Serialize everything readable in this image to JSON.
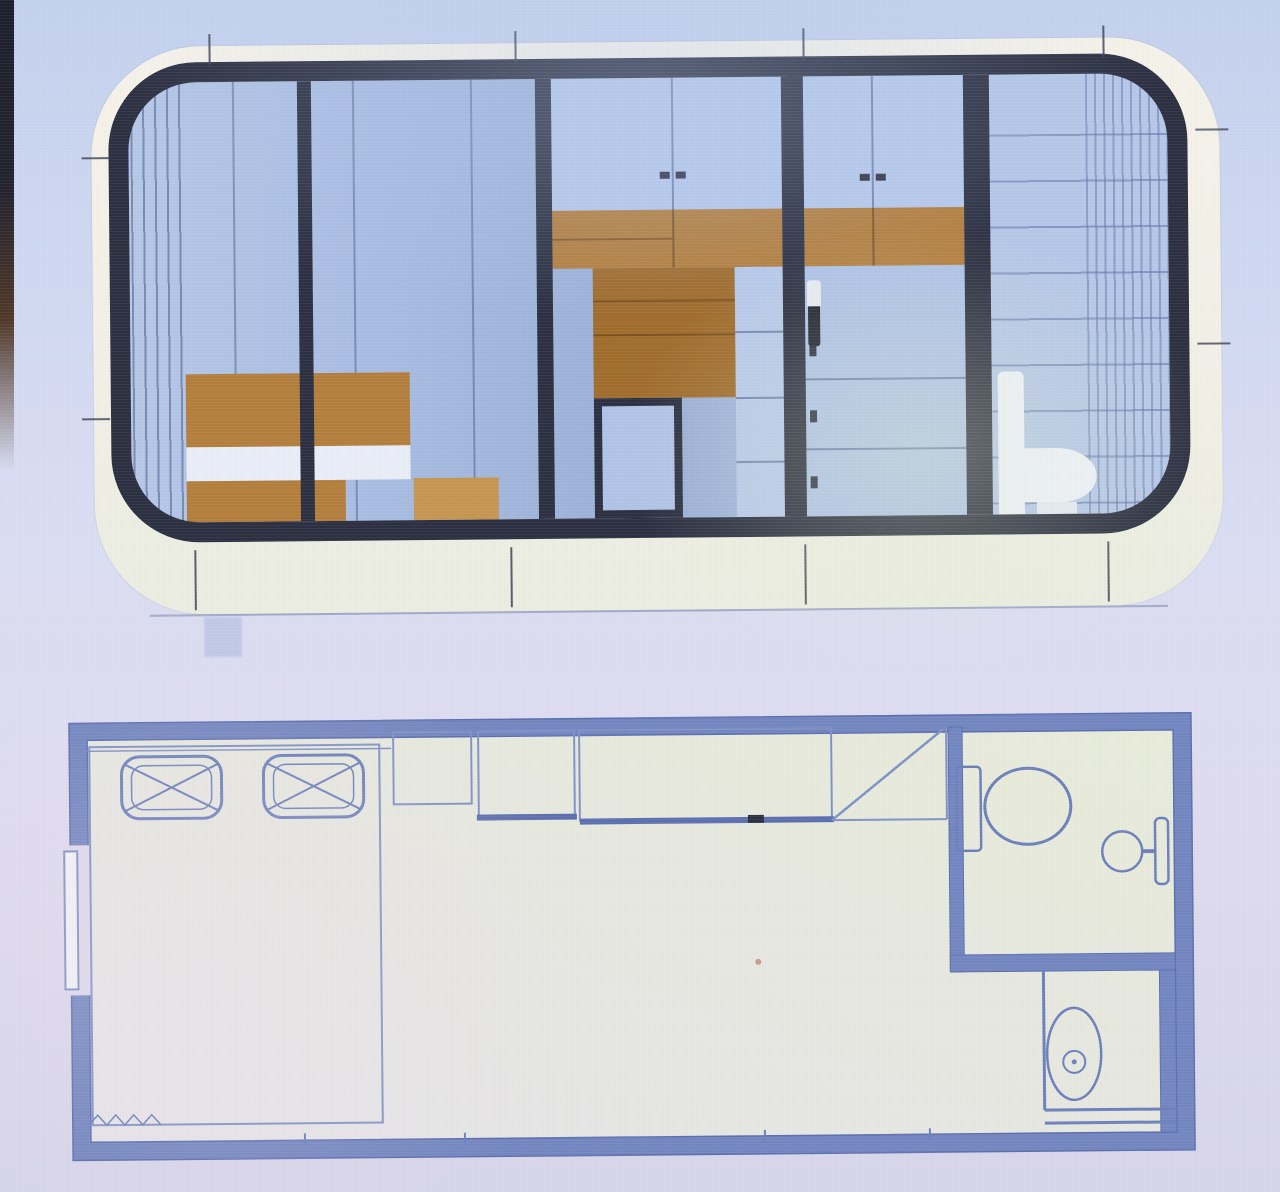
{
  "meta": {
    "kind": "photo-of-screen",
    "subject": "capsule tiny-house CAD drawing: side elevation above, floor plan below",
    "visible_text": "none"
  },
  "palette": {
    "bg_top": "#c3d1ed",
    "bg_mid": "#dbddf2",
    "bg_bottom": "#d7d5e9",
    "edge_dark": "#1b1f2b",
    "edge_brown": "#4f3827",
    "body": "#f5f2e9",
    "body_low": "#eaede0",
    "frame": "#2b2f40",
    "glass": "#a8bde2",
    "glass_light": "#b5c7e7",
    "tile_line": "#5f78ab",
    "wood": "#b37e3c",
    "wood_dark": "#a06c2c",
    "wood_light": "#c59551",
    "bedding": "#e9edf6",
    "cabinet": "#b7c9ea",
    "drawer": "#aec2e6",
    "seam": "#50699f",
    "plan_wall": "#7386bf",
    "plan_wall_edge": "#5c6fae",
    "plan_line": "#7f92c4",
    "plan_floor": "#e7eadd",
    "fixture": "#6c80ba",
    "tick": "#3c4254",
    "ground": "#8f9ab9",
    "shadow": "#97a8d6",
    "white_fixture": "#edf1f8",
    "artifact_red": "#b5544a"
  },
  "elevation": {
    "name": "capsule-side-elevation",
    "window_panes": 5,
    "furniture": [
      "bed",
      "nightstand",
      "wardrobe-shelving",
      "cabinet-drawers",
      "toilet"
    ],
    "dimension_ticks": {
      "top": 4,
      "bottom": 4,
      "left": 2,
      "right": 2
    }
  },
  "floor_plan": {
    "name": "capsule-floor-plan",
    "rooms": [
      "bedroom",
      "living-area",
      "bathroom",
      "laundry-nook"
    ],
    "fixtures": [
      "double-bed",
      "pillow-left",
      "pillow-right",
      "wardrobe-cabinets",
      "door-swing",
      "toilet",
      "hand-basin",
      "washing-machine",
      "entry-door",
      "threshold-hatch"
    ]
  }
}
